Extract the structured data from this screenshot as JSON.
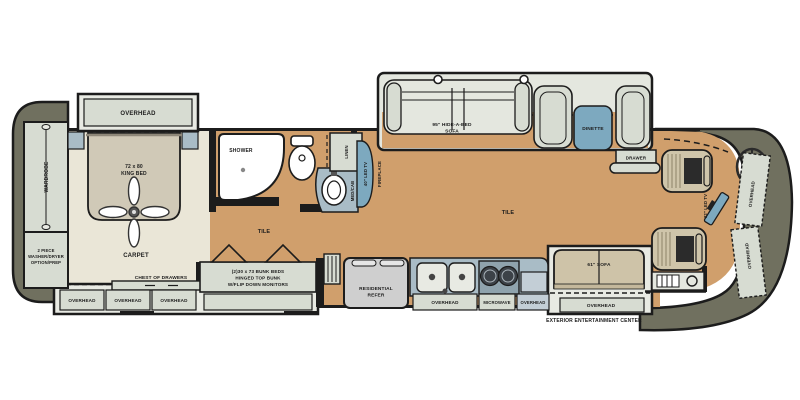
{
  "plan": {
    "type": "RV floor plan",
    "bedroom": {
      "slide_overhead": "OVERHEAD",
      "wardrobe": "WARDROBE",
      "washer_l1": "2 PIECE",
      "washer_l2": "WASHER/DRYER",
      "washer_l3": "OPTION/PREP",
      "king_bed_l1": "72 x 80",
      "king_bed_l2": "KING BED",
      "carpet": "CARPET",
      "chest_of_drawers": "CHEST OF DRAWERS",
      "overhead": "OVERHEAD"
    },
    "bath": {
      "shower": "SHOWER",
      "linen": "LINEN",
      "med_cab": "MED/CAB",
      "tv_40": "40\" LED TV",
      "fireplace": "FIREPLACE",
      "tile": "TILE"
    },
    "bunkroom": {
      "bunks_l1": "(2)30 x 73 BUNK BEDS",
      "bunks_l2": "HINGED TOP BUNK",
      "bunks_l3": "W/FLIP DOWN MONITORS"
    },
    "living": {
      "hide_a_bed_l1": "95\" HIDE-A-BED",
      "hide_a_bed_l2": "SOFA",
      "dinette": "DINETTE",
      "drawer": "DRAWER",
      "tile": "TILE"
    },
    "kitchen": {
      "refer_l1": "RESIDENTIAL",
      "refer_l2": "REFER",
      "overhead": "OVERHEAD",
      "microwave": "MICROWAVE",
      "sofa_61": "61\" SOFA",
      "exterior_entertainment": "EXTERIOR ENTERTAINMENT CENTER"
    },
    "cockpit": {
      "tv_32": "32\" LED TV",
      "overhead": "OVERHEAD"
    }
  },
  "colors": {
    "tile_floor": "#d09f6c",
    "carpet_floor": "#eae6d7",
    "cabinet": "#d7dcd2",
    "slide_shell": "#e8eae3",
    "counter": "#a9bcc6",
    "table_blue": "#7da9bf",
    "cap_gray": "#70705f",
    "sofa_wood": "#cec3a8",
    "seat_tan": "#cfc5aa",
    "wall_black": "#1c1c1c",
    "white": "#ffffff"
  }
}
